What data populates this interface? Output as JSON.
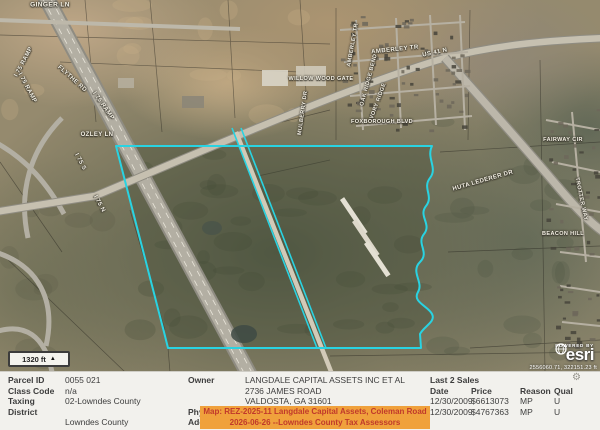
{
  "map": {
    "scale_bar_label": "1320 ft",
    "attribution": {
      "powered_by": "POWERED BY",
      "brand": "esri",
      "coordinates": "2556060.71, 322151.23 ft"
    },
    "colors": {
      "parcel_outline": "#29d3e2",
      "highlight_bg": "#f0a13c",
      "highlight_text": "#c0392b",
      "note_red": "#d93a2d"
    },
    "labels": [
      {
        "text": "GINGER LN",
        "x": 50,
        "y": 5,
        "rot": 0,
        "size": 6.5
      },
      {
        "text": "I 75 RAMP",
        "x": 24,
        "y": 62,
        "rot": -62,
        "size": 6
      },
      {
        "text": "I 75 RAMP",
        "x": 27,
        "y": 88,
        "rot": 62,
        "size": 6
      },
      {
        "text": "FLYTHE RD",
        "x": 72,
        "y": 79,
        "rot": 42,
        "size": 6
      },
      {
        "text": "I 75 RAMP",
        "x": 103,
        "y": 106,
        "rot": 55,
        "size": 6
      },
      {
        "text": "OZLEY LN",
        "x": 97,
        "y": 135,
        "rot": 0,
        "size": 6
      },
      {
        "text": "I 75 S",
        "x": 80,
        "y": 162,
        "rot": 62,
        "size": 6
      },
      {
        "text": "I 75 N",
        "x": 99,
        "y": 204,
        "rot": 62,
        "size": 6
      },
      {
        "text": "AMBERLEY TR",
        "x": 353,
        "y": 45,
        "rot": -80,
        "size": 5.5
      },
      {
        "text": "AMBERLEY TR",
        "x": 395,
        "y": 50,
        "rot": -6,
        "size": 6
      },
      {
        "text": "US 41 N",
        "x": 435,
        "y": 53,
        "rot": -12,
        "size": 6
      },
      {
        "text": "WILLOW WOOD GATE",
        "x": 321,
        "y": 79,
        "rot": 0,
        "size": 5.5
      },
      {
        "text": "OAK RIDGE BEND",
        "x": 369,
        "y": 80,
        "rot": -75,
        "size": 5.5
      },
      {
        "text": "IVORY RIDGE",
        "x": 378,
        "y": 102,
        "rot": -70,
        "size": 5.5
      },
      {
        "text": "MULBERRY DR",
        "x": 303,
        "y": 113,
        "rot": -82,
        "size": 5.5
      },
      {
        "text": "FOXBOROUGH BLVD",
        "x": 382,
        "y": 122,
        "rot": 0,
        "size": 5.5
      },
      {
        "text": "HUTA LEDERER DR",
        "x": 483,
        "y": 181,
        "rot": -16,
        "size": 6
      },
      {
        "text": "FAIRWAY CIR",
        "x": 563,
        "y": 140,
        "rot": 0,
        "size": 5.5
      },
      {
        "text": "TROTTER WAY",
        "x": 581,
        "y": 199,
        "rot": 78,
        "size": 5.5
      },
      {
        "text": "BEACON HILL",
        "x": 563,
        "y": 234,
        "rot": 0,
        "size": 5.5
      }
    ]
  },
  "panel": {
    "left": {
      "parcel_id_label": "Parcel ID",
      "parcel_id": "0055 021",
      "class_code_label": "Class Code",
      "class_code": "n/a",
      "taxing_district_label": "Taxing District",
      "taxing_district_1": "02-Lowndes County",
      "taxing_district_2": "Lowndes County",
      "acres_label": "Acres",
      "acres": "707.35",
      "note": "(Note: Not to be used on legal documents)"
    },
    "mid": {
      "owner_label": "Owner",
      "owner_1": "LANGDALE CAPITAL ASSETS INC ET AL",
      "owner_2": "2736 JAMES ROAD",
      "owner_3": "VALDOSTA, GA 31601",
      "physical_address_label": "Physical Address",
      "physical_address": "COLEMAN RD N",
      "assessor_fragment": "Ass"
    },
    "highlight": {
      "line1": "Map: REZ-2025-11 Langdale Capital Assets, Coleman Road",
      "line2": "2026-06-26 --Lowndes County Tax Assessors"
    },
    "sales": {
      "title": "Last 2 Sales",
      "columns": [
        "Date",
        "Price",
        "Reason",
        "Qual"
      ],
      "rows": [
        [
          "12/30/2009",
          "$6613073",
          "MP",
          "U"
        ],
        [
          "12/30/2009",
          "$4767363",
          "MP",
          "U"
        ]
      ]
    },
    "settings_icon": "⚙"
  }
}
